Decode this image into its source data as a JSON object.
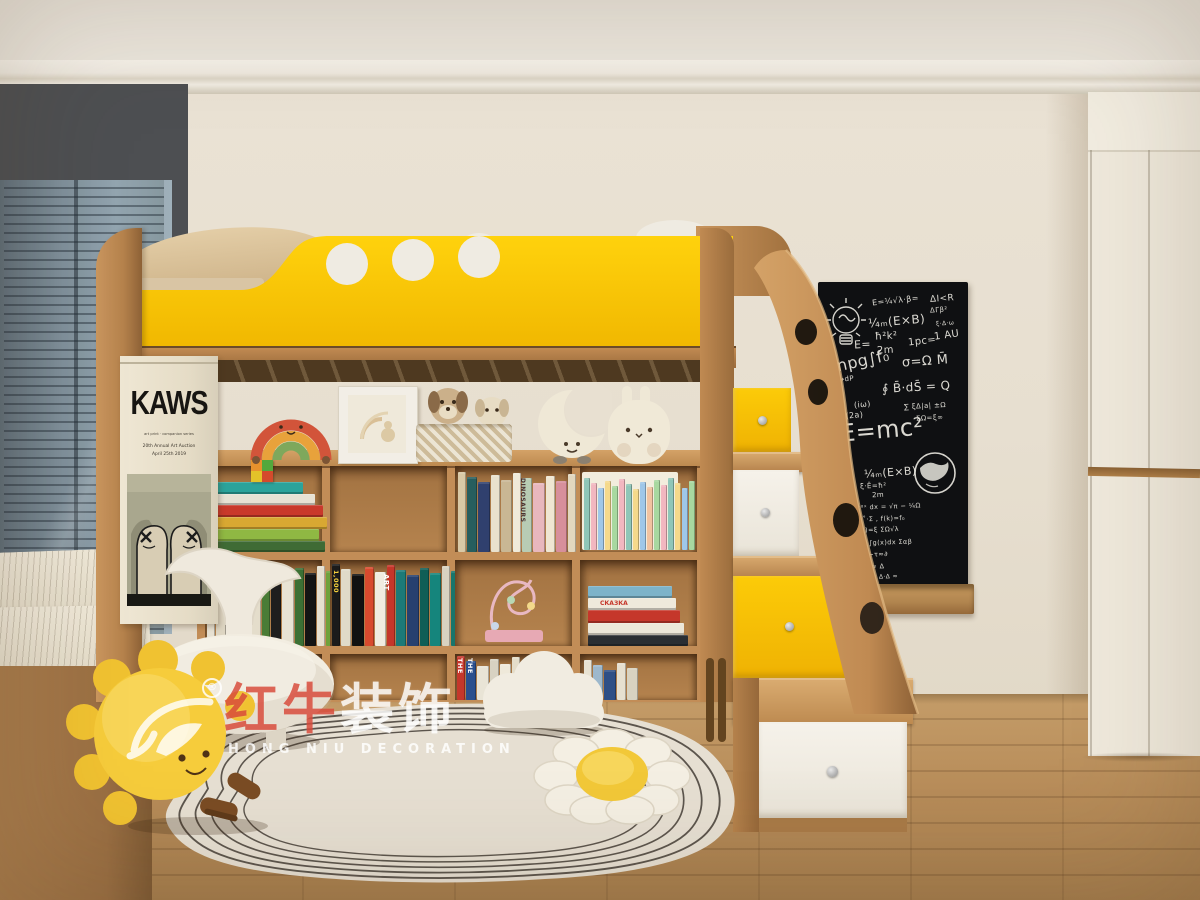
{
  "watermark": {
    "brand_cn_red": "红牛",
    "brand_cn_white": "装饰",
    "brand_en": "HONG NIU DECORATION",
    "registered": "®"
  },
  "poster": {
    "title": "KAWS",
    "caption": "art print · companion series",
    "line1": "20th Annual Art Auction",
    "line2": "April 25th 2019"
  },
  "blackboard": {
    "chalk_color": "#eceae2",
    "formulas": [
      {
        "t": "E=¼√λ·β=",
        "x": 54,
        "y": 14,
        "s": 8,
        "r": -6
      },
      {
        "t": "ΔI<R",
        "x": 112,
        "y": 12,
        "s": 9,
        "r": -4
      },
      {
        "t": "ΔΓβ²",
        "x": 112,
        "y": 24,
        "s": 7,
        "r": -4
      },
      {
        "t": "¼ₘ(E×B)",
        "x": 50,
        "y": 32,
        "s": 12,
        "r": -5
      },
      {
        "t": "ξ·Δ·ω",
        "x": 118,
        "y": 38,
        "s": 6,
        "r": -4
      },
      {
        "t": "1 AU",
        "x": 116,
        "y": 48,
        "s": 10,
        "r": -8
      },
      {
        "t": "E=",
        "x": 36,
        "y": 56,
        "s": 11,
        "r": -3
      },
      {
        "t": "ħ²k²",
        "x": 57,
        "y": 49,
        "s": 10,
        "r": -3
      },
      {
        "t": "2m",
        "x": 59,
        "y": 63,
        "s": 10,
        "r": -3
      },
      {
        "t": "1pc=",
        "x": 90,
        "y": 54,
        "s": 10,
        "r": -6
      },
      {
        "t": "Snpg∫f₀",
        "x": 8,
        "y": 70,
        "s": 16,
        "r": -12
      },
      {
        "t": "σ=Ω M̄",
        "x": 84,
        "y": 72,
        "s": 13,
        "r": -4
      },
      {
        "t": "↑dP ⇢dP",
        "x": 2,
        "y": 94,
        "s": 7,
        "r": -6
      },
      {
        "t": "P̄~P̄¹",
        "x": 0,
        "y": 106,
        "s": 8,
        "r": -4
      },
      {
        "t": "∮ B̄·dS̄ = Q",
        "x": 64,
        "y": 98,
        "s": 12,
        "r": -3
      },
      {
        "t": "(iω)",
        "x": 36,
        "y": 118,
        "s": 8,
        "r": -6
      },
      {
        "t": "ξ~√ω (2a)",
        "x": 0,
        "y": 130,
        "s": 8,
        "r": -5
      },
      {
        "t": "∑ ξΔ|a| ±Ω",
        "x": 86,
        "y": 120,
        "s": 7,
        "r": -3
      },
      {
        "t": "E=mc²",
        "x": 22,
        "y": 134,
        "s": 24,
        "r": -5
      },
      {
        "t": "ΣΩ=ξ∞",
        "x": 98,
        "y": 132,
        "s": 7,
        "r": -3
      },
      {
        "t": "¼ₘ(E×B)",
        "x": 46,
        "y": 184,
        "s": 11,
        "r": -4
      },
      {
        "t": "ξ·Ē=ħ²",
        "x": 42,
        "y": 200,
        "s": 7,
        "r": -2
      },
      {
        "t": "2m",
        "x": 54,
        "y": 209,
        "s": 7,
        "r": -2
      },
      {
        "t": "∂=∫₀˚ e⁻ᵅˣ dx = √π − ¼Ω",
        "x": 12,
        "y": 221,
        "s": 6.5,
        "r": -2
      },
      {
        "t": "f(x)=ξ˚·Σ ,  f(k)=f₀",
        "x": 22,
        "y": 233,
        "s": 6.5,
        "r": -2
      },
      {
        "t": "f(x)·f(k)=ξ ΣΩ√λ",
        "x": 22,
        "y": 244,
        "s": 6.5,
        "r": -2
      },
      {
        "t": "∂=∫f(x)dx+∫g(x)dx  Σαβ",
        "x": 10,
        "y": 257,
        "s": 6.5,
        "r": -2
      },
      {
        "t": "Σττ≈∞ ·  ξ−τ≈∂",
        "x": 14,
        "y": 269,
        "s": 6.5,
        "r": -2
      },
      {
        "t": "∫Σ 6πT√λ ≈ Δ",
        "x": 18,
        "y": 281,
        "s": 6.5,
        "r": -2
      },
      {
        "t": "4 quadrants Δ·Δ ≈",
        "x": 18,
        "y": 292,
        "s": 6,
        "r": -2
      }
    ]
  },
  "books": {
    "stack_r1c1": {
      "colors": [
        "#3f6b35",
        "#8fb843",
        "#d8a832",
        "#c9392b",
        "#e7e2d4",
        "#2ba39b"
      ],
      "heights": [
        11,
        12,
        12,
        12,
        11,
        12
      ],
      "widths": [
        118,
        112,
        120,
        116,
        108,
        96
      ]
    },
    "vert_r1c3": {
      "colors": [
        "#d9c9a6",
        "#275e5e",
        "#30406e",
        "#e9e1cd",
        "#c9b794",
        "#f0ead9",
        "#b8ccb4",
        "#e8b7bd",
        "#efe6d2",
        "#d78f9b",
        "#e2d7bf"
      ],
      "baseH": 80
    },
    "series_r1c4": {
      "colors": [
        "#8fc6b8",
        "#f2b7c0",
        "#9fc7e8",
        "#f5d98b",
        "#a8d8a0",
        "#f2b7c0",
        "#8fc6b8",
        "#f5d98b",
        "#9fc7e8",
        "#f2c3a0",
        "#a8d8a0",
        "#f2b7c0",
        "#8fc6b8",
        "#f5d98b",
        "#9fc7e8",
        "#a8d8a0"
      ],
      "baseH": 72,
      "uw": 6
    },
    "art_r2c1": {
      "colors": [
        "#e7e1d2",
        "#ddd5c2",
        "#f0ebdd",
        "#cfc8b5",
        "#e4ddcb",
        "#4a7c36",
        "#1e1e1e",
        "#e8e3d4",
        "#3c7034",
        "#141414",
        "#e6e0d0",
        "#6fa23c",
        "#f7f3e8"
      ],
      "baseH": 82
    },
    "art_r2c2": {
      "colors": [
        "#1b1b1b",
        "#e0dac8",
        "#111111",
        "#d84a2e",
        "#f0ece0",
        "#c5362a",
        "#1c7a78",
        "#27406f",
        "#0f5e56",
        "#15857c",
        "#d8d2c0",
        "#18756b",
        "#c23b2b"
      ],
      "baseH": 82
    },
    "stack_r2c4": {
      "colors": [
        "#2a2e33",
        "#ece7d9",
        "#c5372b",
        "#efe9db",
        "#7db3c9"
      ],
      "heights": [
        11,
        12,
        13,
        12,
        12
      ],
      "widths": [
        100,
        96,
        92,
        88,
        84
      ]
    },
    "vert_r3c3": {
      "colors": [
        "#c5372b",
        "#2b4f8e",
        "#e9e4d6",
        "#d8d2c2",
        "#efe9da",
        "#e4ddca"
      ],
      "baseH": 44
    },
    "vert_r3c4": {
      "colors": [
        "#e8e2d2",
        "#9db8cc",
        "#2e4f86",
        "#e6e0d0",
        "#d8d2c0"
      ],
      "baseH": 40
    }
  },
  "book_labels": {
    "dinosaurs": "DINOSAURS",
    "thousand": "1,000",
    "art": "ART",
    "the_red": "THE",
    "the_blue": "THE",
    "skazka": "СКАЗКА"
  },
  "colors": {
    "accent_yellow": "#f6c303",
    "wood": "#c08a52",
    "wall": "#e8e0d1",
    "blackboard": "#0f1012",
    "floor": "#b78b58",
    "rug": "#e5ded0",
    "window_frame": "#4d4f52",
    "brand_red": "#d84a3a"
  }
}
